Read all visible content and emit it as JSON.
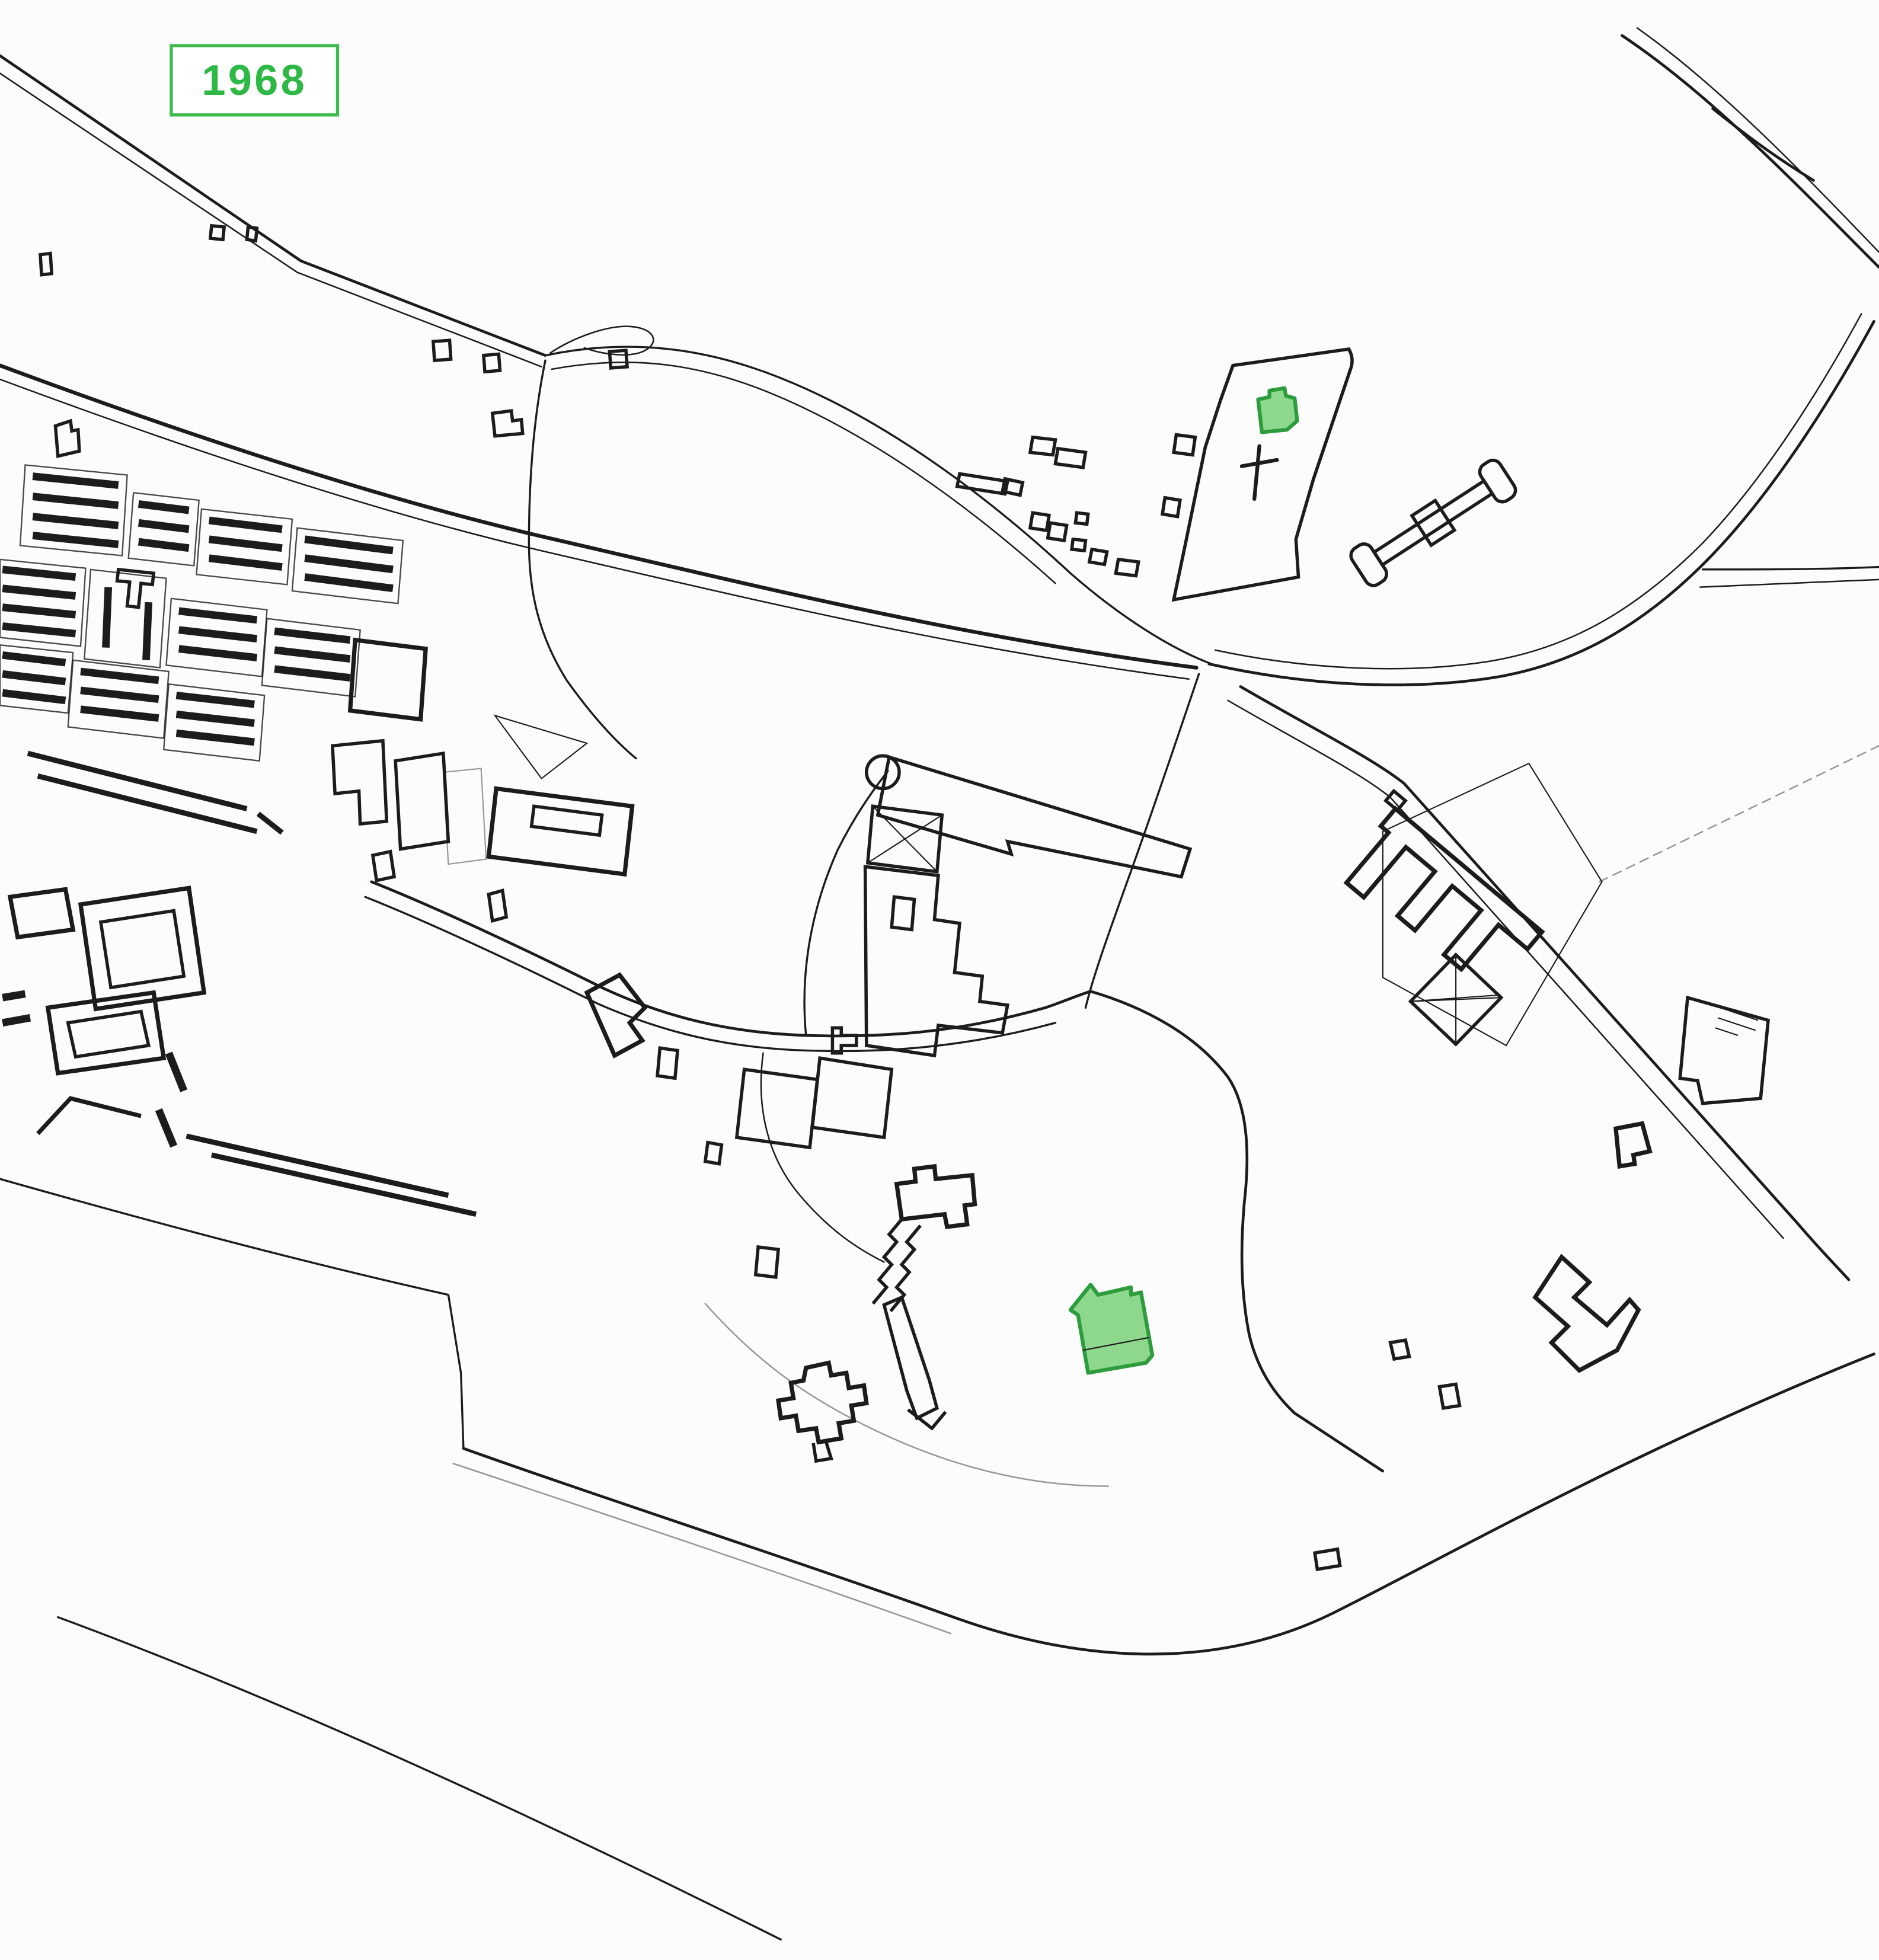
{
  "map": {
    "year_label": "1968",
    "colors": {
      "background": "#fcfcfc",
      "ink": "#1c1c1c",
      "label_text": "#2eb845",
      "label_border": "#3dbb4d",
      "highlight_fill": "#8ed88e",
      "highlight_stroke": "#2d9c3d"
    },
    "highlighted_buildings": [
      {
        "id": "cemetery-chapel",
        "note": "small green building inside cemetery parcel"
      },
      {
        "id": "park-main-building",
        "note": "large green building in park area"
      }
    ],
    "symbols": [
      {
        "id": "cemetery-cross",
        "note": "cross mark inside cemetery parcel"
      }
    ]
  }
}
